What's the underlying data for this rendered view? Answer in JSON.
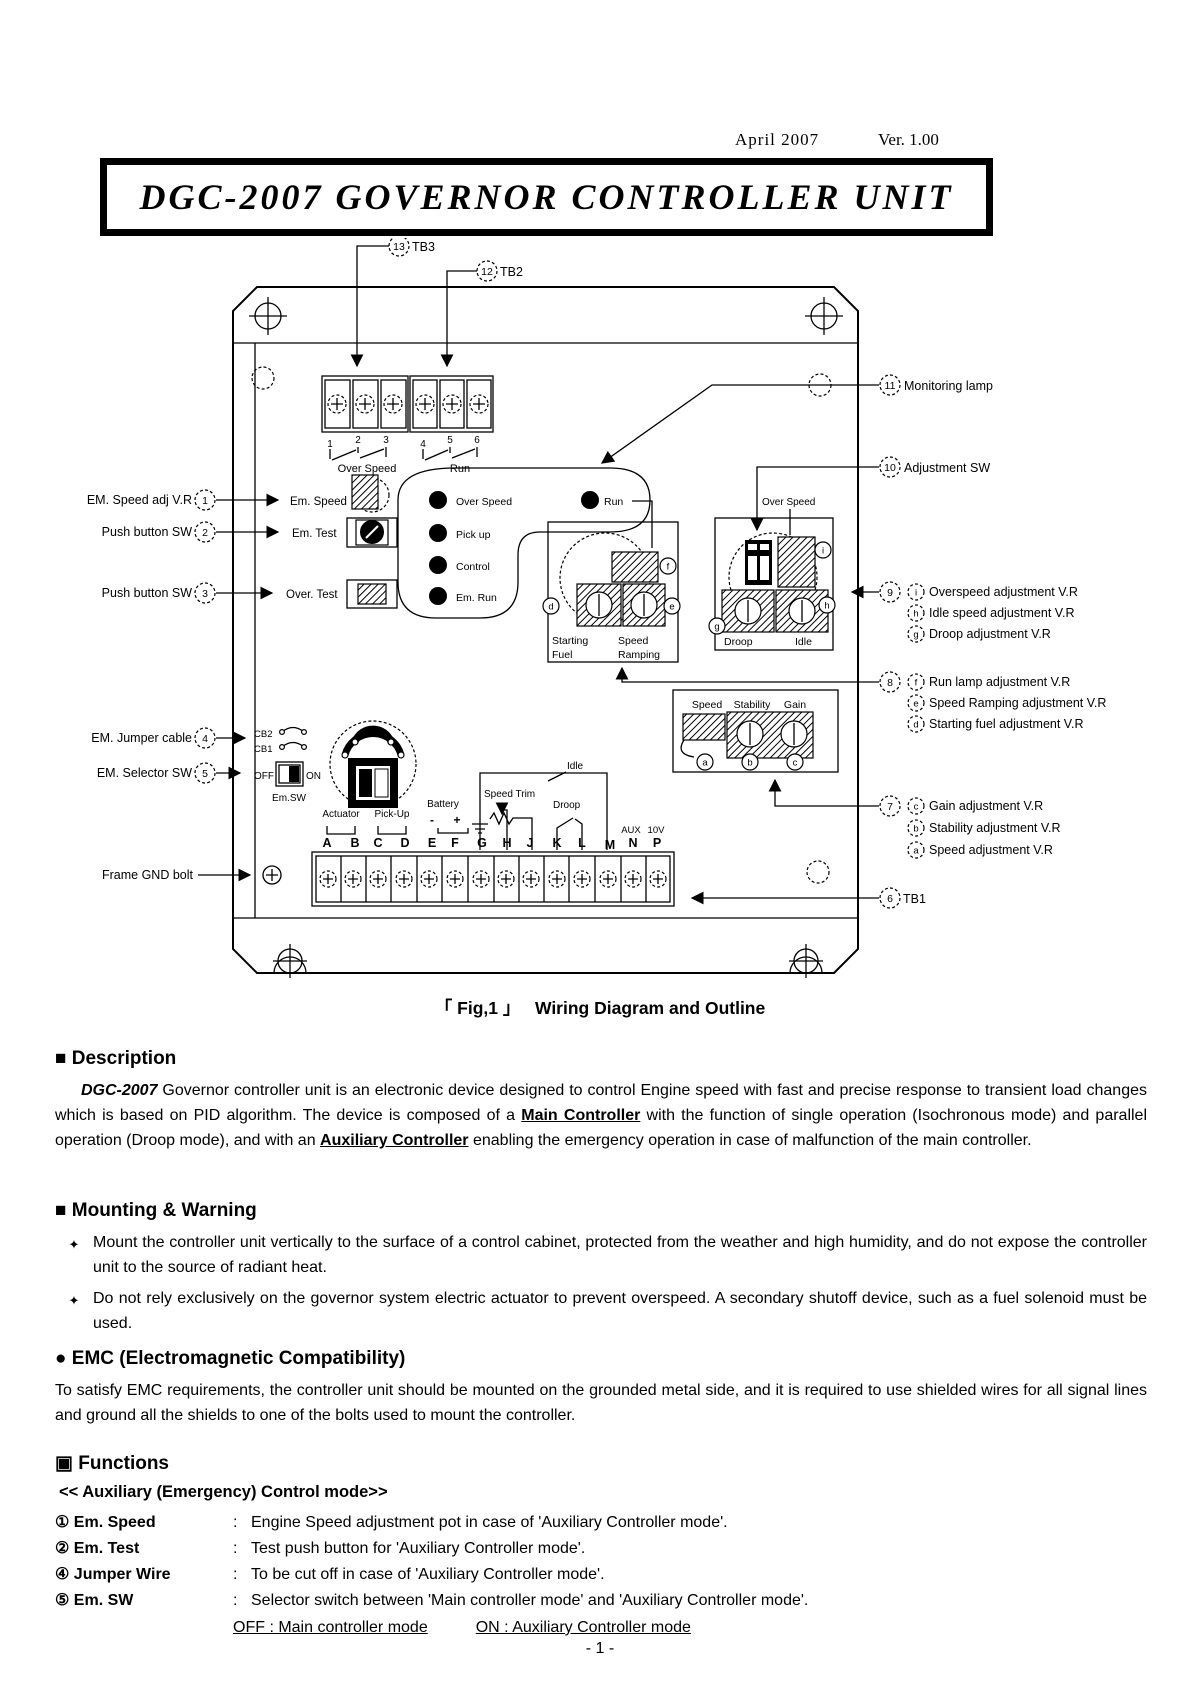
{
  "header": {
    "date": "April 2007",
    "version": "Ver. 1.00",
    "title": "DGC-2007 GOVERNOR CONTROLLER UNIT"
  },
  "figure": {
    "caption_open": "「",
    "caption_fig": "Fig,1",
    "caption_close": "」",
    "caption_text": "Wiring Diagram and Outline",
    "tb3_terminals": [
      "1",
      "2",
      "3"
    ],
    "tb2_terminals": [
      "4",
      "5",
      "6"
    ],
    "relay_overspeed_label": "Over Speed",
    "relay_run_label": "Run",
    "lamp_labels": [
      "Over Speed",
      "Pick up",
      "Control",
      "Em. Run"
    ],
    "run_lamp_label": "Run",
    "em_speed_label": "Em. Speed",
    "em_test_label": "Em. Test",
    "over_test_label": "Over. Test",
    "cb2": "CB2",
    "cb1": "CB1",
    "off": "OFF",
    "on": "ON",
    "em_sw": "Em.SW",
    "box_fuel": {
      "line1a": "Starting",
      "line1b": "Fuel",
      "line2a": "Speed",
      "line2b": "Ramping",
      "pot_d": "d",
      "pot_e": "e",
      "pot_f": "f"
    },
    "box_droop": {
      "title": "Over Speed",
      "label1": "Droop",
      "label2": "Idle",
      "pot_g": "g",
      "pot_h": "h",
      "pot_i": "i"
    },
    "box_gain": {
      "label1": "Speed",
      "label2": "Stability",
      "label3": "Gain",
      "pot_a": "a",
      "pot_b": "b",
      "pot_c": "c"
    },
    "actuator": "Actuator",
    "pickup": "Pick-Up",
    "battery": "Battery",
    "minus": "-",
    "plus": "+",
    "speed_trim": "Speed Trim",
    "droop_switch": "Droop",
    "idle_switch": "Idle",
    "aux": "AUX",
    "aux_v": "10V",
    "terminals": [
      "A",
      "B",
      "C",
      "D",
      "E",
      "F",
      "G",
      "H",
      "J",
      "K",
      "L",
      "M",
      "N",
      "P"
    ]
  },
  "callouts": {
    "left": [
      {
        "num": "1",
        "label": "EM. Speed adj V.R"
      },
      {
        "num": "2",
        "label": "Push button SW"
      },
      {
        "num": "3",
        "label": "Push button SW"
      },
      {
        "num": "4",
        "label": "EM. Jumper cable"
      },
      {
        "num": "5",
        "label": "EM. Selector SW"
      }
    ],
    "frame_gnd": "Frame GND bolt",
    "tb3": {
      "num": "13",
      "label": "TB3"
    },
    "tb2": {
      "num": "12",
      "label": "TB2"
    },
    "monitoring": {
      "num": "11",
      "label": "Monitoring lamp"
    },
    "adjustment": {
      "num": "10",
      "label": "Adjustment SW"
    },
    "c9": {
      "num": "9",
      "items": [
        {
          "key": "i",
          "text": "Overspeed adjustment V.R"
        },
        {
          "key": "h",
          "text": "Idle speed adjustment V.R"
        },
        {
          "key": "g",
          "text": "Droop adjustment V.R"
        }
      ]
    },
    "c8": {
      "num": "8",
      "items": [
        {
          "key": "f",
          "text": "Run lamp adjustment V.R"
        },
        {
          "key": "e",
          "text": "Speed Ramping adjustment V.R"
        },
        {
          "key": "d",
          "text": "Starting fuel adjustment V.R"
        }
      ]
    },
    "c7": {
      "num": "7",
      "items": [
        {
          "key": "c",
          "text": "Gain adjustment V.R"
        },
        {
          "key": "b",
          "text": "Stability adjustment V.R"
        },
        {
          "key": "a",
          "text": "Speed adjustment V.R"
        }
      ]
    },
    "c6": {
      "num": "6",
      "label": "TB1"
    }
  },
  "sections": {
    "description": {
      "icon": "■",
      "heading": "Description",
      "intro_bold": "DGC-2007",
      "body_1": " Governor controller unit is an electronic device designed to control Engine speed with fast and precise response to transient load changes which is based on PID algorithm. The device is composed of a ",
      "main_ctrl": "Main Controller",
      "body_2": " with the function of single operation (Isochronous mode) and parallel operation (Droop mode), and with an ",
      "aux_ctrl": "Auxiliary Controller",
      "body_3": " enabling the emergency operation in case of malfunction of the main controller."
    },
    "mounting": {
      "icon": "■",
      "heading": "Mounting & Warning",
      "bullet_char": "✦",
      "bullets": [
        "Mount the controller unit vertically to the surface of a control cabinet, protected from the weather and high humidity, and do not expose the controller unit to the source of radiant heat.",
        "Do not rely exclusively on the governor system electric actuator to prevent overspeed. A secondary shutoff device, such as a fuel solenoid must be used."
      ]
    },
    "emc": {
      "icon": "●",
      "heading": "EMC (Electromagnetic Compatibility)",
      "body": "To satisfy EMC requirements, the controller unit should be mounted on the grounded metal side, and it is required to use shielded wires for all signal lines and ground all the shields to one of the bolts used to mount the controller."
    },
    "functions": {
      "icon": "▣",
      "heading": "Functions",
      "subheading": "<< Auxiliary (Emergency) Control mode>>",
      "colon": ":",
      "items": [
        {
          "num": "①",
          "term": "Em. Speed",
          "desc": "Engine Speed adjustment pot in case of 'Auxiliary Controller mode'."
        },
        {
          "num": "②",
          "term": "Em. Test",
          "desc": "Test push button for 'Auxiliary Controller mode'."
        },
        {
          "num": "④",
          "term": "Jumper Wire",
          "desc": "To be cut off in case of 'Auxiliary Controller mode'."
        },
        {
          "num": "⑤",
          "term": "Em. SW",
          "desc": "Selector switch between 'Main controller mode' and 'Auxiliary Controller mode'."
        }
      ],
      "mode_off": "OFF : Main controller mode",
      "mode_on": "ON : Auxiliary Controller mode"
    }
  },
  "footer": {
    "page": "- 1 -"
  }
}
